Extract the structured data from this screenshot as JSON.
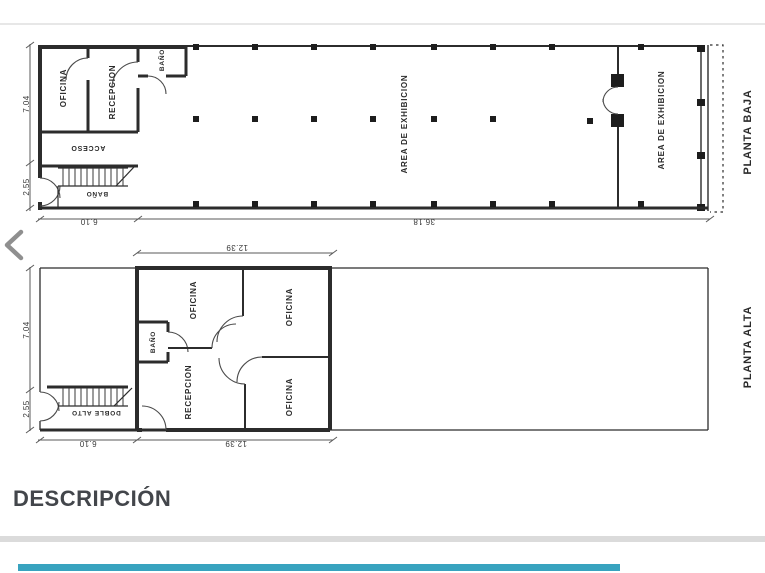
{
  "gallery": {
    "prev_icon": "chevron-left"
  },
  "plans": {
    "baja": {
      "title": "PLANTA BAJA",
      "oficina": "OFICINA",
      "recepcion": "RECEPCION",
      "bano_top": "BAÑO",
      "acceso": "ACCESO",
      "bano_bottom": "BAÑO",
      "exhibicion1": "AREA DE EXHIBICION",
      "exhibicion2": "AREA DE EXHIBICION",
      "dim_704": "7.04",
      "dim_255": "2.55",
      "dim_610": "6.10",
      "dim_3618": "36.18"
    },
    "alta": {
      "title": "PLANTA ALTA",
      "oficina_mid": "OFICINA",
      "oficina_top": "OFICINA",
      "oficina_bottom": "OFICINA",
      "recepcion": "RECEPCION",
      "bano": "BAÑO",
      "doble_alto": "DOBLE ALTO",
      "dim_1239_top": "12.39",
      "dim_1239_bottom": "12.39",
      "dim_704": "7.04",
      "dim_255": "2.55",
      "dim_610": "6.10"
    }
  },
  "description": {
    "heading": "DESCRIPCIÓN"
  },
  "colors": {
    "accent_bar": "#38a3bf",
    "divider": "#dbdbdb",
    "heading_text": "#43464b"
  }
}
